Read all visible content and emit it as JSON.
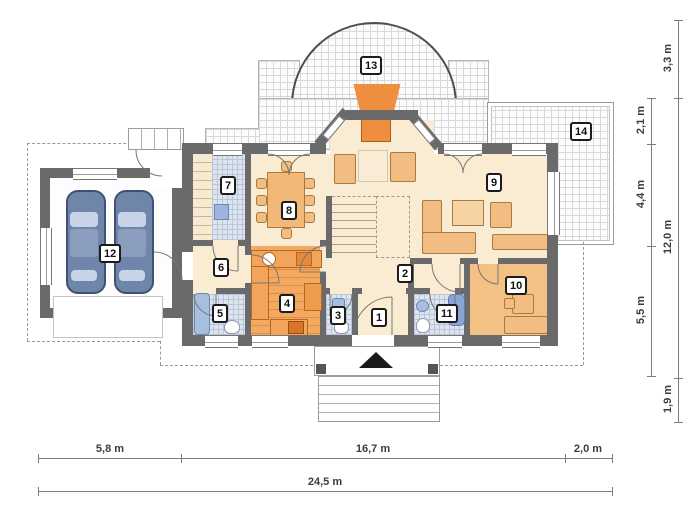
{
  "title": "house-ground-floor-plan",
  "rooms": {
    "r1": "1",
    "r2": "2",
    "r3": "3",
    "r4": "4",
    "r5": "5",
    "r6": "6",
    "r7": "7",
    "r8": "8",
    "r9": "9",
    "r10": "10",
    "r11": "11",
    "r12": "12",
    "r13": "13",
    "r14": "14"
  },
  "dimensions": {
    "bottom_segments": [
      "5,8 m",
      "16,7 m",
      "2,0 m"
    ],
    "bottom_total": "24,5 m",
    "right_inner_segments": [
      "2,1 m",
      "4,4 m",
      "5,5 m"
    ],
    "right_outer_top": "3,3 m",
    "right_outer_mid": "12,0 m",
    "right_outer_bottom": "1,9 m"
  },
  "colors": {
    "wall": "#6a6a6a",
    "floor_cream": "#f9ecd3",
    "kitchen_floor": "#f4a963",
    "room10_floor": "#f3c183",
    "tile_blue": "#dde4ee",
    "bathtub_blue": "#8aa5d3",
    "car_blue": "#7085aa",
    "fireplace_orange": "#ee8f3f",
    "terrace_grid_line": "#d9d9d9",
    "furniture_tan": "#f2bd83"
  },
  "icons": {
    "entrance_arrow": "entrance-arrow",
    "cars": "two parked cars in garage"
  }
}
